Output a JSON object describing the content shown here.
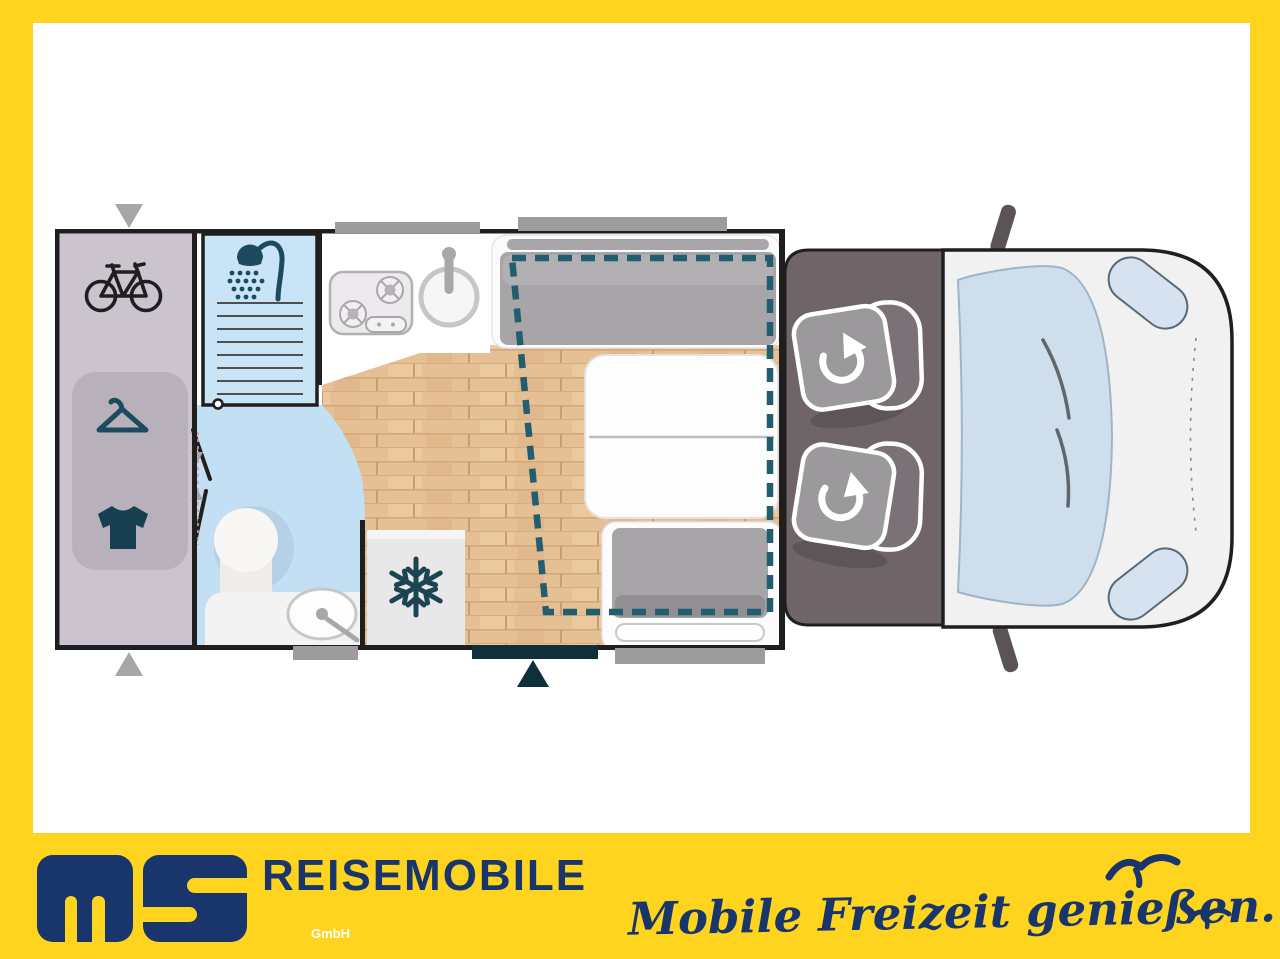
{
  "brand": {
    "logo_text": "ms",
    "logo_suffix": "GmbH",
    "title": "REISEMOBILE",
    "tagline": "Mobile Freizeit genießen."
  },
  "colors": {
    "frame_yellow": "#ffd41e",
    "panel_white": "#ffffff",
    "brand_navy": "#18366b",
    "wall_black": "#1f1f1f",
    "garage_lavender": "#cbc3cd",
    "wardrobe_panel": "#b8b0ba",
    "bath_blue": "#c3dff4",
    "shower_blue": "#c9e4f7",
    "wood_floor": "#e5c095",
    "cushion_gray": "#a7a5a7",
    "cab_gray": "#6f6569",
    "seat_base_gray": "#9b999b",
    "seat_back_gray": "#7b7278",
    "van_body": "#f2f1f2",
    "windshield_blue": "#cfdeed",
    "icon_teal": "#1d4a5e",
    "dropdown_bed_dash": "#235d70",
    "window_marker_gray": "#9d9b9d",
    "door_marker_dark": "#0f2f3a"
  },
  "floorplan": {
    "type": "motorhome-top-view",
    "areas": [
      {
        "name": "rear-garage",
        "icons": [
          "bike-icon",
          "hanger-icon",
          "shirt-icon"
        ]
      },
      {
        "name": "bathroom",
        "icons": [
          "shower-icon",
          "toilet-icon",
          "washbasin-icon"
        ]
      },
      {
        "name": "kitchen",
        "icons": [
          "hob-icon",
          "sink-icon"
        ]
      },
      {
        "name": "fridge",
        "icons": [
          "snowflake-icon"
        ]
      },
      {
        "name": "dinette",
        "icons": [
          "bench-seat",
          "table",
          "bench-seat"
        ]
      },
      {
        "name": "drop-down-bed",
        "icons": [
          "dashed-outline"
        ]
      },
      {
        "name": "cab",
        "icons": [
          "swivel-seat-icon",
          "swivel-seat-icon"
        ]
      },
      {
        "name": "vehicle-front",
        "icons": [
          "windshield",
          "mirror-icon",
          "headlight"
        ]
      }
    ],
    "markers": [
      "garage-door-arrow-top",
      "garage-door-arrow-bottom",
      "entrance-door-arrow"
    ]
  }
}
